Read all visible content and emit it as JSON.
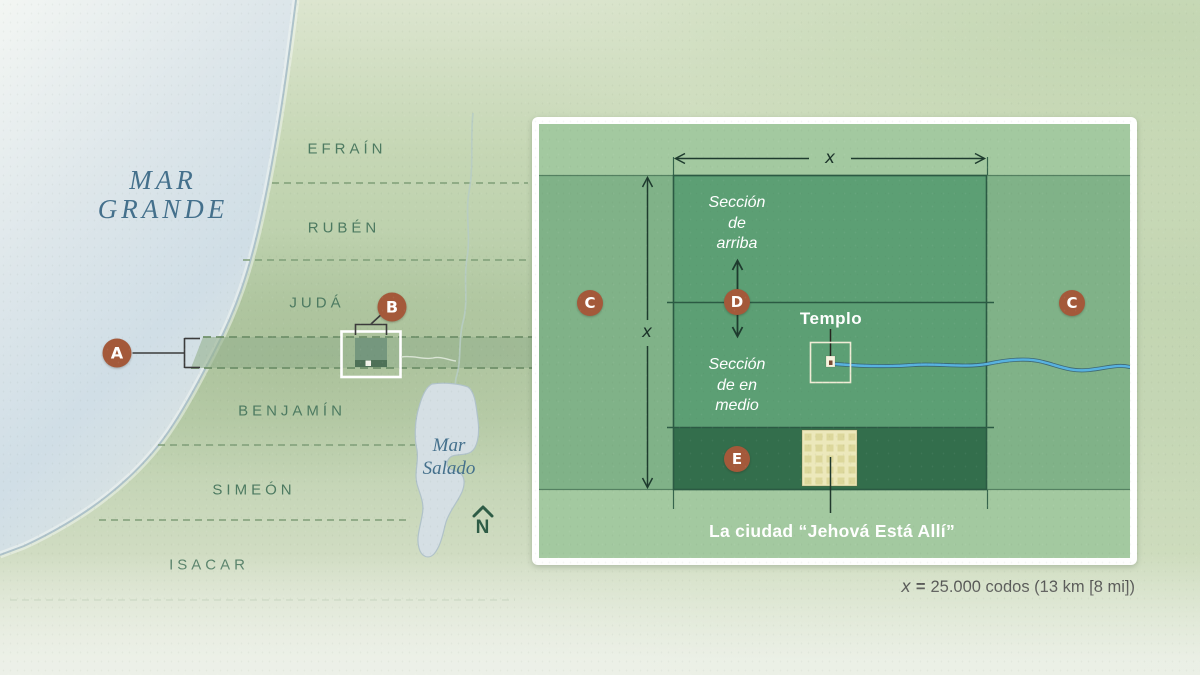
{
  "map": {
    "great_sea": [
      "MAR",
      "GRANDE"
    ],
    "tribes": [
      "EFRAÍN",
      "RUBÉN",
      "JUDÁ",
      "BENJAMÍN",
      "SIMEÓN",
      "ISACAR"
    ],
    "salt_sea": [
      "Mar",
      "Salado"
    ],
    "compass": "N",
    "markers": {
      "a": "A",
      "b": "B"
    }
  },
  "inset": {
    "markers": {
      "c": "C",
      "d": "D",
      "e": "E"
    },
    "dim": "x",
    "section_upper": [
      "Sección",
      "de",
      "arriba"
    ],
    "section_middle": [
      "Sección",
      "de en",
      "medio"
    ],
    "temple": "Templo",
    "city": "La ciudad “Jehová Está Allí”"
  },
  "legend": {
    "var": "x",
    "eq": "=",
    "text": "25.000 codos (13 km [8 mi])"
  },
  "colors": {
    "marker": "#a4593a",
    "river": "#58b2e0",
    "square": "#5c9f74",
    "strip": "#336e4c",
    "band": "#80b288",
    "inset_bg": "#a3c9a0",
    "sea_label": "#44708c",
    "tribe": "#4d7a61"
  }
}
